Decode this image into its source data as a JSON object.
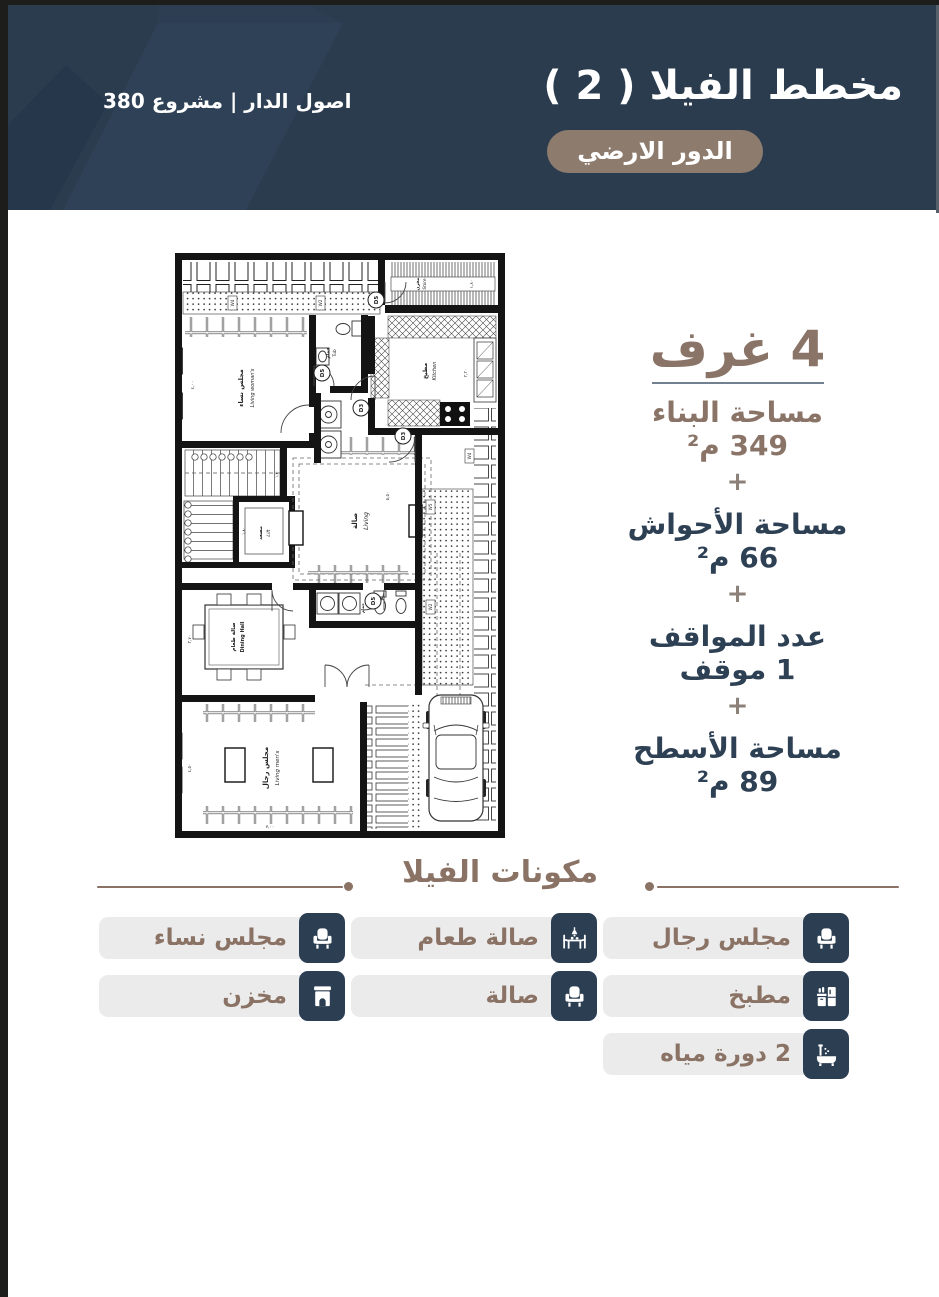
{
  "header": {
    "title": "مخطط الفيلا ( 2 )",
    "badge": "الدور الارضي",
    "brand": "اصول الدار | مشروع 380",
    "bg_color": "#2b3c4f",
    "badge_color": "#8d7b6e"
  },
  "stats": {
    "rooms_label": "4 غرف",
    "plus": "+",
    "accent_brown": "#8a7468",
    "accent_navy": "#2e4054",
    "items": [
      {
        "label": "مساحة البناء",
        "value": "349 م²"
      },
      {
        "label": "مساحة الأحواش",
        "value": "66 م²"
      },
      {
        "label": "عدد المواقف",
        "value": "1 موقف"
      },
      {
        "label": "مساحة الأسطح",
        "value": "89 م²"
      }
    ]
  },
  "components": {
    "title": "مكونات الفيلا",
    "items": [
      {
        "label": "مجلس رجال",
        "icon": "armchair-icon"
      },
      {
        "label": "صالة طعام",
        "icon": "dining-table-icon"
      },
      {
        "label": "مجلس نساء",
        "icon": "armchair-icon"
      },
      {
        "label": "مطبخ",
        "icon": "kitchen-icon"
      },
      {
        "label": "صالة",
        "icon": "armchair-icon"
      },
      {
        "label": "مخزن",
        "icon": "storage-icon"
      },
      {
        "label": "2 دورة مياه",
        "icon": "bath-icon"
      }
    ]
  },
  "floorplan": {
    "rooms": {
      "living_womans": {
        "ar": "مجلس نساء",
        "en": "Living woman's"
      },
      "tub1": {
        "ar": "حمام",
        "en": "Tub"
      },
      "kitchen": {
        "ar": "مطبخ",
        "en": "Kitchen"
      },
      "store": {
        "ar": "مخزن",
        "en": "Store"
      },
      "lift": {
        "ar": "مصعد",
        "en": "Lift"
      },
      "living": {
        "ar": "صالة",
        "en": "Living"
      },
      "dining": {
        "ar": "صالة طعام",
        "en": "Dining Hall"
      },
      "tub2": {
        "ar": "حمام",
        "en": "Tub"
      },
      "living_mens": {
        "ar": "مجلس رجال",
        "en": "Living men's"
      }
    },
    "doors": {
      "d5": "D5",
      "d3": "D3"
    },
    "windows": {
      "w2": "W2",
      "w4": "W4",
      "w5": "W5"
    },
    "dims": {
      "living_womans": "٤,٠٠",
      "kitchen": "٣,٣٠",
      "store": "١,٨٠",
      "living": "٥,٥٠",
      "stairs": "١,٣٠",
      "lift": "١,٨٠",
      "dining": "٣,٧٠",
      "mens_w": "٤,٥٠",
      "mens_l": "٧,٠٠"
    }
  }
}
